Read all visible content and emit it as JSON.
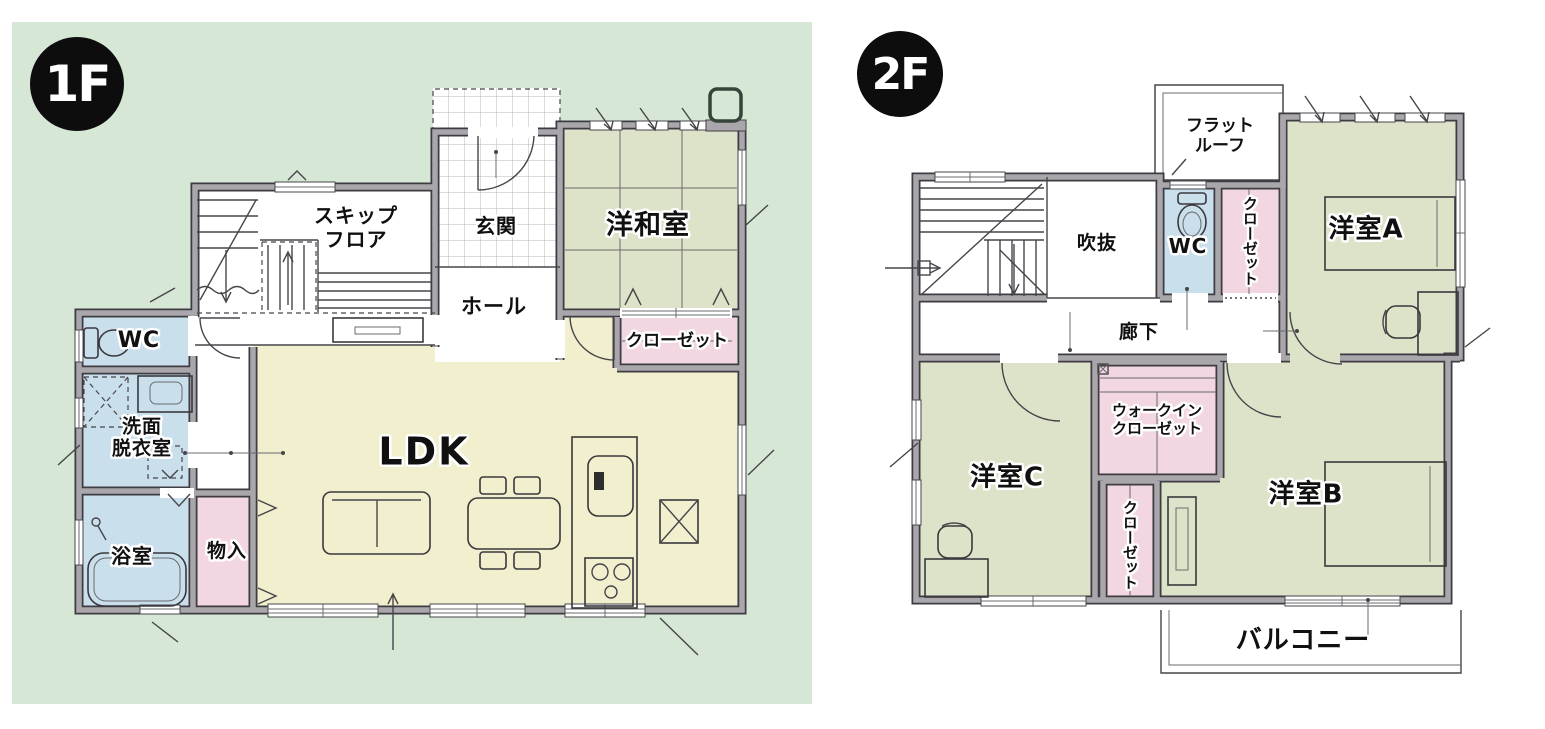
{
  "floor1": {
    "badge": "1F",
    "rooms": {
      "skip_floor": "スキップ\nフロア",
      "genkan": "玄関",
      "yowashitsu": "洋和室",
      "hall": "ホール",
      "wc": "WC",
      "senmen": "洗面\n脱衣室",
      "yokushitsu": "浴室",
      "mononyu": "物入",
      "ldk": "LDK",
      "closet": "クローゼット"
    }
  },
  "floor2": {
    "badge": "2F",
    "rooms": {
      "flat_roof": "フラット\nルーフ",
      "fukinuke": "吹抜",
      "wc": "WC",
      "closet_a": "クローゼット",
      "yoshitsu_a": "洋室A",
      "rouka": "廊下",
      "yoshitsu_c": "洋室C",
      "walk_in_closet": "ウォークイン\nクローゼット",
      "closet_b": "クローゼット",
      "yoshitsu_b": "洋室B",
      "balcony": "バルコニー"
    }
  },
  "colors": {
    "background_panel_green": "#d6e7d5",
    "room_green": "#dde3c8",
    "room_yellow": "#f1efce",
    "room_blue": "#c9dfec",
    "room_pink": "#f2d7e2",
    "wall_gray": "#a9a7ab",
    "line_dark": "#3e3c42",
    "badge_black": "#0d0d0d"
  }
}
